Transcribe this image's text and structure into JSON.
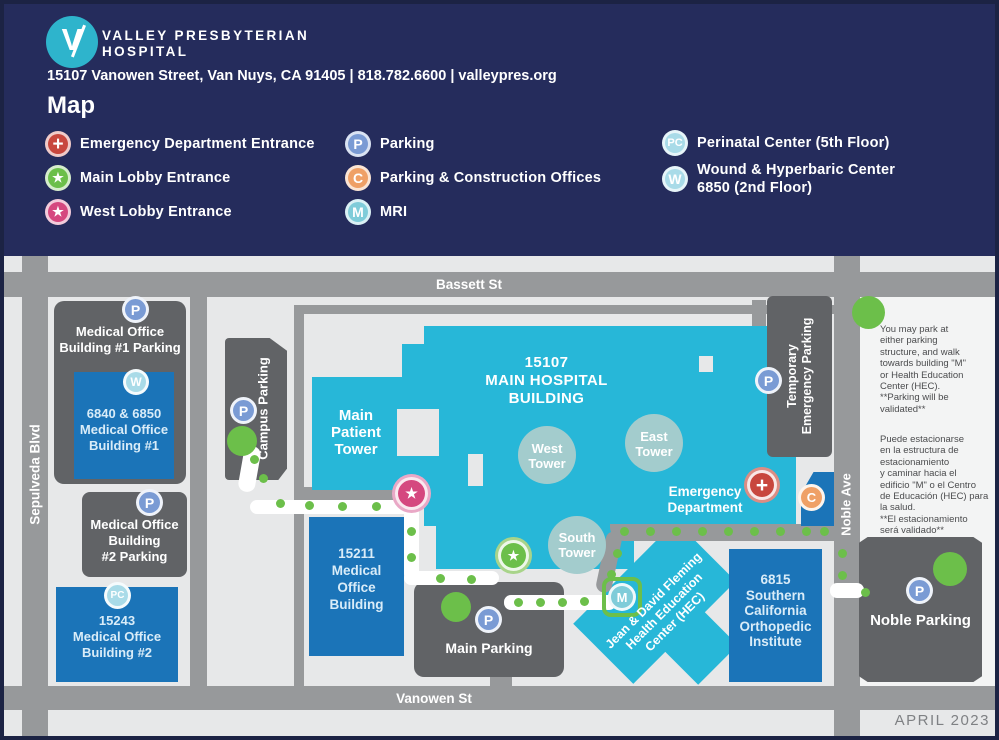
{
  "header": {
    "logo_letter": "V",
    "name_line1": "VALLEY PRESBYTERIAN",
    "name_line2": "HOSPITAL",
    "address": "15107 Vanowen Street, Van Nuys, CA 91405 | 818.782.6600 | valleypres.org",
    "title": "Map"
  },
  "icons": {
    "parking": "P",
    "construction": "C",
    "mri": "M",
    "perinatal": "PC",
    "wound": "W",
    "plus": "+",
    "star": "★"
  },
  "legend": {
    "col1": [
      {
        "icon": "emergency-entrance",
        "label": "Emergency Department Entrance"
      },
      {
        "icon": "main-lobby-entrance",
        "label": "Main Lobby Entrance"
      },
      {
        "icon": "west-lobby-entrance",
        "label": "West Lobby Entrance"
      }
    ],
    "col2": [
      {
        "icon": "parking",
        "label": "Parking"
      },
      {
        "icon": "parking-construction",
        "label": "Parking & Construction Offices"
      },
      {
        "icon": "mri",
        "label": "MRI"
      }
    ],
    "col3": [
      {
        "icon": "perinatal-center",
        "label": "Perinatal Center (5th Floor)"
      },
      {
        "icon": "wound-center",
        "label": "Wound & Hyperbaric Center\n6850 (2nd Floor)"
      }
    ]
  },
  "map": {
    "streets": {
      "top": "Bassett St",
      "bottom": "Vanowen St",
      "left": "Sepulveda Blvd",
      "right": "Noble Ave"
    },
    "buildings": {
      "mob1_parking": "Medical Office\nBuilding #1 Parking",
      "mob1": "6840 & 6850\nMedical Office\nBuilding #1",
      "mob2_parking": "Medical Office\nBuilding\n#2 Parking",
      "mob2": "15243\nMedical Office\nBuilding #2",
      "campus_parking": "Campus Parking",
      "mob15211": "15211\nMedical\nOffice\nBuilding",
      "main_parking": "Main Parking",
      "hospital": "15107\nMAIN HOSPITAL\nBUILDING",
      "main_patient_tower": "Main\nPatient\nTower",
      "west_tower": "West\nTower",
      "east_tower": "East\nTower",
      "south_tower": "South\nTower",
      "emergency_department": "Emergency\nDepartment",
      "temp_parking_line1": "Temporary",
      "temp_parking_line2": "Emergency Parking",
      "hec": "Jean & David Fleming\nHealth Education\nCenter (HEC)",
      "scoi": "6815\nSouthern\nCalifornia\nOrthopedic\nInstitute",
      "noble_parking": "Noble Parking"
    },
    "notes": {
      "english": "You may park at\neither parking\nstructure, and walk\ntowards building \"M\"\nor Health Education\nCenter (HEC).\n**Parking will be\nvalidated**",
      "spanish": "Puede estacionarse\nen la estructura de\nestacionamiento\ny caminar hacia el\nedificio \"M\" o el Centro\nde Educación (HEC) para\nla salud.\n**El estacionamiento\nserá validado**"
    },
    "date": "APRIL 2023"
  },
  "colors": {
    "header_bg": "#252c5c",
    "map_bg": "#e7e8e9",
    "street_gray": "#97999b",
    "building_gray": "#616366",
    "building_blue": "#1b74b8",
    "hospital_cyan": "#27b7d8",
    "tower_circle": "#a3cccd",
    "path_green": "#6cbf4a",
    "parking_badge_blue": "#7a9bd4",
    "pale_blue_badge": "#a9dbe8",
    "construction_orange": "#efa066",
    "emergency_red": "#c8473e",
    "west_lobby_pink": "#d5487f",
    "mri_teal": "#7fccd9"
  }
}
